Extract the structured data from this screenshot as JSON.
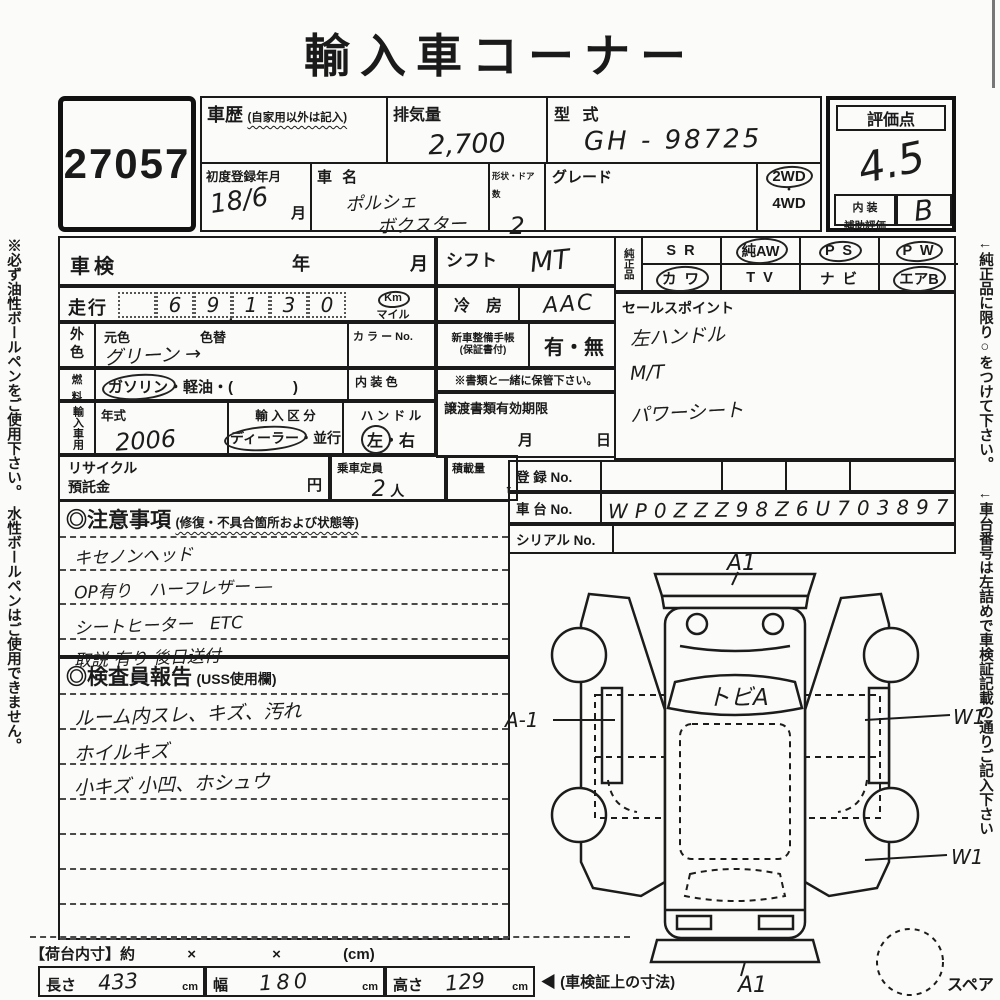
{
  "title": "輸入車コーナー",
  "side_notes": {
    "left": "※必ず油性ボールペンをご使用下さい。　水性ボールペンはご使用できません。",
    "right_top": "←純正品に限り○をつけて下さい。",
    "right_bottom": "←車台番号は左詰めで車検証記載の通りご記入下さい"
  },
  "lot_number": "27057",
  "header": {
    "history_label": "車歴",
    "history_note": "(自家用以外は記入)",
    "displacement_label": "排気量",
    "displacement_value": "2,700",
    "model_code_label": "型 式",
    "model_code_value": "GH - 98725",
    "first_reg_label": "初度登録年月",
    "first_reg_value": "18/6",
    "first_reg_unit": "月",
    "name_label": "車 名",
    "name_line1": "ポルシェ",
    "name_line2": "ボクスター",
    "shape_label": "形状・ドア数",
    "shape_value": "2",
    "grade_label": "グレード",
    "drive_2wd": "2WD",
    "drive_dot": "・",
    "drive_4wd": "4WD"
  },
  "rating": {
    "label": "評価点",
    "score": "4.5",
    "interior_label1": "内 装",
    "interior_label2": "補助評価",
    "interior_score": "B"
  },
  "inspection": {
    "shaken_label": "車検",
    "year_label": "年",
    "month_label": "月"
  },
  "mileage": {
    "label": "走行",
    "digits": [
      "",
      "6",
      "9",
      "1",
      "3",
      "0"
    ],
    "comma": ",",
    "unit_km": "Km",
    "unit_mile": "マイル"
  },
  "color": {
    "header1": "外",
    "header2": "色",
    "orig_label": "元色",
    "repaint_label": "色替",
    "value": "グリーン →",
    "color_no_label": "カ ラ ー No."
  },
  "fuel": {
    "header1": "燃",
    "header2": "料",
    "circled": "ガソリン",
    "rest": "・軽油・(　　　　)",
    "interior_color_label": "内 装 色"
  },
  "import_row": {
    "header": "輸入車用",
    "year_label": "年式",
    "year_value": "2006",
    "division_label": "輸 入 区 分",
    "division_circled": "ディーラー",
    "division_rest": "・並行",
    "handle_label": "ハ ン ド ル",
    "handle_left": "左",
    "handle_dot": "・",
    "handle_right": "右"
  },
  "recycle": {
    "label1": "リサイクル",
    "label2": "預託金",
    "unit": "円",
    "capacity_label": "乗車定員",
    "capacity_value": "2",
    "capacity_unit": "人",
    "load_label": "積載量",
    "load_unit": "t"
  },
  "mid": {
    "shift_label": "シフト",
    "shift_value": "MT",
    "ac_label": "冷　房",
    "ac_value": "AAC",
    "book_label1": "新車整備手帳",
    "book_label2": "(保証書付)",
    "book_value": "有・無",
    "keep_note": "※書類と一緒に保管下さい。",
    "transfer_label": "譲渡書類有効期限",
    "transfer_month": "月",
    "transfer_day": "日"
  },
  "genuine": {
    "header": "純正品",
    "row1": [
      {
        "label": "S R"
      },
      {
        "label": "純AW"
      },
      {
        "label": "P S"
      },
      {
        "label": "P W"
      }
    ],
    "row2": [
      {
        "label": "カ ワ"
      },
      {
        "label": "T V"
      },
      {
        "label": "ナ ビ"
      },
      {
        "label": "エアB"
      }
    ]
  },
  "sales_points": {
    "label": "セールスポイント",
    "lines": [
      "左ハンドル",
      "M/T",
      "パワーシート"
    ]
  },
  "registration": {
    "reg_label": "登 録 No.",
    "chassis_label": "車 台 No.",
    "chassis_value": "WP0ZZZ98Z6U703897",
    "serial_label": "シリアル No."
  },
  "notes": {
    "title": "◎注意事項",
    "subtitle": "(修復・不具合箇所および状態等)",
    "lines": [
      "キセノンヘッド",
      "OP有り　ハーフレザー ―",
      "シートヒーター　ETC",
      "取説 有り 後日送付"
    ]
  },
  "inspector": {
    "title": "◎検査員報告",
    "subtitle": "(USS使用欄)",
    "lines": [
      "ルーム内スレ、キズ、汚れ",
      "ホイルキズ",
      "小キズ 小凹、ホシュウ",
      "",
      "",
      "",
      ""
    ]
  },
  "diagram": {
    "front_mark": "A1",
    "windshield_mark": "トビA",
    "left_mark": "A-1",
    "right_top_mark": "W1",
    "right_bottom_mark": "W1",
    "rear_mark": "A1",
    "spare_label": "スペア"
  },
  "dimensions": {
    "title": "【荷台内寸】約",
    "times1": "×",
    "times2": "×",
    "unit_note": "(cm)",
    "length_label": "長さ",
    "length_value": "433",
    "length_unit": "cm",
    "width_label": "幅",
    "width_value": "180",
    "width_unit": "cm",
    "height_label": "高さ",
    "height_value": "129",
    "height_unit": "cm",
    "ref_note": "◀ (車検証上の寸法)"
  }
}
